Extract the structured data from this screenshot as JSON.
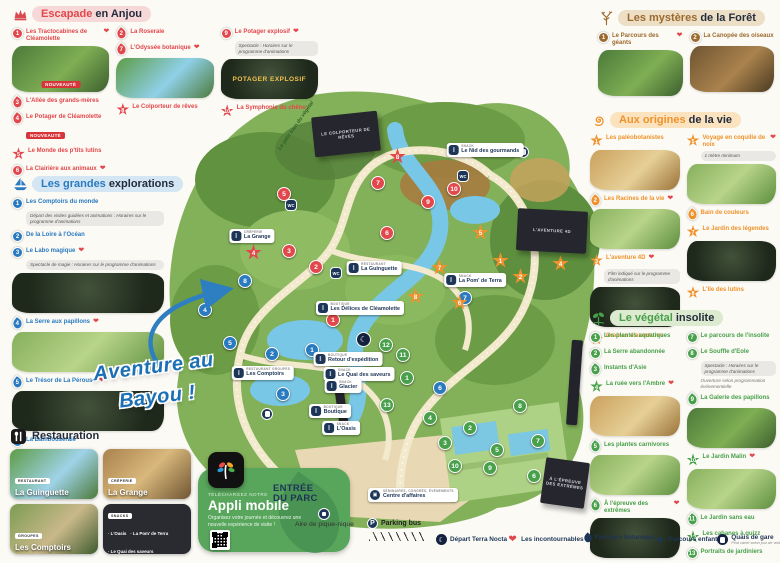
{
  "sections": {
    "escapade": {
      "title_accent": "Escapade",
      "title_rest": "en Anjou",
      "columns": [
        [
          {
            "n": 1,
            "sh": "c",
            "label": "Les Tractocabines de Cléamolette",
            "heart": true,
            "img": "th-g1",
            "img_badge": "NOUVEAUTÉ"
          },
          {
            "n": 3,
            "sh": "leaf",
            "label": "L'Allée des grands-mères"
          },
          {
            "n": 4,
            "sh": "leaf",
            "label": "Le Potager de Cléamolette",
            "badge": "NOUVEAUTÉ"
          },
          {
            "n": 5,
            "sh": "star",
            "label": "Le Monde des p'tits lutins"
          },
          {
            "n": 6,
            "sh": "c",
            "label": "La Clairière aux animaux",
            "heart": true
          }
        ],
        [
          {
            "n": 2,
            "sh": "leaf",
            "label": "La Roseraie"
          },
          {
            "n": 7,
            "sh": "leaf",
            "label": "L'Odyssée botanique",
            "heart": true,
            "img": "th-b1"
          },
          {
            "n": 8,
            "sh": "star",
            "label": "Le Colporteur de rêves"
          }
        ],
        [
          {
            "n": 9,
            "sh": "c",
            "label": "Le Potager explosif",
            "heart": true,
            "note": "Spectacle : Horaires sur le programme d'animations",
            "img": "th-d1",
            "img_text": "POTAGER EXPLOSIF"
          },
          {
            "n": 10,
            "sh": "star",
            "label": "La Symphonie du chêne"
          }
        ]
      ]
    },
    "explorations": {
      "title_accent": "Les grandes",
      "title_rest": "explorations",
      "columns": [
        [
          {
            "n": 1,
            "sh": "c",
            "label": "Les Comptoirs du monde",
            "note": "Départ des visites guidées et animations : Horaires sur le programme d'animations"
          },
          {
            "n": 2,
            "sh": "c",
            "label": "De la Loire à l'Océan"
          },
          {
            "n": 3,
            "sh": "c",
            "label": "Le Labo magique",
            "heart": true,
            "note": "Spectacle de magie : Horaires sur le programme d'animations",
            "img": "th-d1"
          },
          {
            "n": 4,
            "sh": "leaf",
            "label": "La Serre aux papillons",
            "heart": true,
            "img": "th-g2"
          },
          {
            "n": 5,
            "sh": "leaf",
            "label": "Le Trésor de La Pérouse",
            "heart": true,
            "img": "th-d1"
          },
          {
            "n": 6,
            "sh": "c",
            "label": "La Bambouseraie"
          },
          {
            "n": 7,
            "sh": "c",
            "label": "L'île aux sons"
          },
          {
            "n": 8,
            "sh": "c",
            "label": "Aventure au Bayou !"
          }
        ]
      ]
    },
    "foret": {
      "title_accent": "Les mystères",
      "title_rest": "de la Forêt",
      "columns": [
        [
          {
            "n": 1,
            "sh": "c",
            "label": "Le Parcours des géants",
            "heart": true,
            "img": "th-g1"
          }
        ],
        [
          {
            "n": 2,
            "sh": "c",
            "label": "La Canopée des oiseaux",
            "img": "th-k1"
          }
        ]
      ]
    },
    "origines": {
      "title_accent": "Aux origines",
      "title_rest": "de la vie",
      "columns": [
        [
          {
            "n": 1,
            "sh": "star",
            "label": "Les paléobotanistes",
            "img": "th-w1"
          },
          {
            "n": 2,
            "sh": "leaf",
            "label": "Les Racines de la vie",
            "heart": true,
            "img": "th-g2"
          },
          {
            "n": 3,
            "sh": "star",
            "label": "L'aventure 4D",
            "heart": true,
            "note": "Film indiqué sur le programme d'animations",
            "img": "th-d1"
          },
          {
            "n": 4,
            "sh": "star",
            "label": "Graines d'aventures"
          }
        ],
        [
          {
            "n": 5,
            "sh": "star",
            "label": "Voyage en coquille de noix",
            "heart": true,
            "note": "1 mètre minimum",
            "img": "th-g2"
          },
          {
            "n": 6,
            "sh": "leaf",
            "label": "Bain de couleurs"
          },
          {
            "n": 7,
            "sh": "star",
            "label": "Le Jardin des légendes",
            "img": "th-d1"
          },
          {
            "n": 8,
            "sh": "star",
            "label": "L'île des lutins"
          }
        ]
      ]
    },
    "vegetal": {
      "title_accent": "Le végétal",
      "title_rest": "insolite",
      "columns": [
        [
          {
            "n": 1,
            "sh": "c",
            "label": "Les plantes aquatiques"
          },
          {
            "n": 2,
            "sh": "c",
            "label": "La Serre abandonnée"
          },
          {
            "n": 3,
            "sh": "leaf",
            "label": "Instants d'Asie"
          },
          {
            "n": 4,
            "sh": "star",
            "label": "La ruée vers l'Ambre",
            "heart": true,
            "img": "th-w1"
          },
          {
            "n": 5,
            "sh": "leaf",
            "label": "Les plantes carnivores",
            "img": "th-g2"
          },
          {
            "n": 6,
            "sh": "leaf",
            "label": "À l'épreuve des extrêmes",
            "heart": true,
            "img": "th-d1"
          }
        ],
        [
          {
            "n": 7,
            "sh": "c",
            "label": "Le parcours de l'insolite"
          },
          {
            "n": 8,
            "sh": "c",
            "label": "Le Souffle d'Eole",
            "note": "Spectacle : Horaires sur le programme d'animations",
            "note2": "Ouverture selon programmation événementielle"
          },
          {
            "n": 9,
            "sh": "leaf",
            "label": "La Galerie des papillons",
            "img": "th-g1"
          },
          {
            "n": 10,
            "sh": "star",
            "label": "Le Jardin Malin",
            "heart": true,
            "img": "th-g2"
          },
          {
            "n": 11,
            "sh": "leaf",
            "label": "Le Jardin sans eau"
          },
          {
            "n": 12,
            "sh": "star",
            "label": "Les cabanes à quizz"
          },
          {
            "n": 13,
            "sh": "c",
            "label": "Portraits de jardiniers"
          }
        ]
      ]
    }
  },
  "restauration": {
    "title": "Restauration",
    "cards": [
      {
        "badge": "RESTAURANT",
        "name": "La Guinguette",
        "style": "rc-1"
      },
      {
        "badge": "CRÊPERIE",
        "name": "La Grange",
        "style": "rc-2"
      },
      {
        "badge": "GROUPES",
        "name": "Les Comptoirs",
        "style": "rc-3"
      },
      {
        "badge": "SNACKS",
        "list": [
          "L'Oasis",
          "La Pom' de Terra",
          "Le Quai des saveurs",
          "Le Nid des gourmands"
        ]
      }
    ]
  },
  "app": {
    "kicker": "TÉLÉCHARGEZ NOTRE",
    "title": "Appli mobile",
    "desc": "Organisez votre journée et découvrez une nouvelle expérience de visite !"
  },
  "bayou": {
    "line1": "Aventure au",
    "line2": "Bayou !"
  },
  "map": {
    "train_label": "Le petit train du végétal",
    "entrance_line1": "ENTRÉE",
    "entrance_line2": "DU PARC",
    "picnic_label": "Aire de pique-nique",
    "parking_label": "Parking bus",
    "business_badge": "SÉMINAIRES, CONGRÈS, ÉVÉNEMENTS",
    "business_name": "Centre d'affaires",
    "pills": [
      {
        "badge": "SNACK",
        "name": "Le Nid des gourmands",
        "x": 340,
        "y": 62
      },
      {
        "badge": "CRÊPERIE",
        "name": "La Grange",
        "x": 107,
        "y": 148
      },
      {
        "badge": "RESTAURANT",
        "name": "La Guinguette",
        "x": 229,
        "y": 180
      },
      {
        "badge": "BOUTIQUE",
        "name": "Les Délices de Cléamolette",
        "x": 215,
        "y": 220
      },
      {
        "badge": "BOUTIQUE",
        "name": "Retour d'expédition",
        "x": 203,
        "y": 271
      },
      {
        "badge": "RESTAURANT GROUPES",
        "name": "Les Comptoirs",
        "x": 118,
        "y": 285
      },
      {
        "badge": "SNACK",
        "name": "Le Quai des saveurs",
        "x": 214,
        "y": 286
      },
      {
        "badge": "SNACK",
        "name": "Glacier",
        "x": 198,
        "y": 298
      },
      {
        "badge": "SNACK",
        "name": "La Pom' de Terra",
        "x": 330,
        "y": 192
      },
      {
        "badge": "BOUTIQUE",
        "name": "Boutique",
        "x": 185,
        "y": 323
      },
      {
        "badge": "SNACK",
        "name": "L'Oasis",
        "x": 196,
        "y": 340
      }
    ],
    "buildings": [
      {
        "text": "LE COLPORTEUR DE RÊVES",
        "x": 168,
        "y": 26,
        "w": 66,
        "h": 40,
        "rot": -6
      },
      {
        "text": "L'AVENTURE 4D",
        "x": 372,
        "y": 122,
        "w": 70,
        "h": 42,
        "rot": 3
      },
      {
        "text": "À L'ÉPREUVE DES EXTRÊMES",
        "x": 398,
        "y": 372,
        "w": 44,
        "h": 46,
        "rot": 8
      }
    ],
    "markers": [
      {
        "t": "red",
        "sh": "c",
        "n": 1,
        "x": 188,
        "y": 232
      },
      {
        "t": "red",
        "sh": "c",
        "n": 2,
        "x": 171,
        "y": 179
      },
      {
        "t": "red",
        "sh": "c",
        "n": 3,
        "x": 144,
        "y": 163
      },
      {
        "t": "red",
        "sh": "s",
        "n": 4,
        "x": 108,
        "y": 164
      },
      {
        "t": "red",
        "sh": "c",
        "n": 5,
        "x": 139,
        "y": 106
      },
      {
        "t": "red",
        "sh": "c",
        "n": 6,
        "x": 242,
        "y": 145
      },
      {
        "t": "red",
        "sh": "c",
        "n": 7,
        "x": 233,
        "y": 95
      },
      {
        "t": "red",
        "sh": "s",
        "n": 8,
        "x": 252,
        "y": 68
      },
      {
        "t": "red",
        "sh": "c",
        "n": 9,
        "x": 283,
        "y": 114
      },
      {
        "t": "red",
        "sh": "c",
        "n": 10,
        "x": 309,
        "y": 101
      },
      {
        "t": "blue",
        "sh": "c",
        "n": 1,
        "x": 167,
        "y": 262
      },
      {
        "t": "blue",
        "sh": "c",
        "n": 2,
        "x": 127,
        "y": 266
      },
      {
        "t": "blue",
        "sh": "c",
        "n": 3,
        "x": 138,
        "y": 306
      },
      {
        "t": "blue",
        "sh": "c",
        "n": 4,
        "x": 60,
        "y": 222
      },
      {
        "t": "blue",
        "sh": "c",
        "n": 5,
        "x": 85,
        "y": 255
      },
      {
        "t": "blue",
        "sh": "c",
        "n": 6,
        "x": 295,
        "y": 300
      },
      {
        "t": "blue",
        "sh": "c",
        "n": 7,
        "x": 320,
        "y": 210
      },
      {
        "t": "blue",
        "sh": "c",
        "n": 8,
        "x": 100,
        "y": 193
      },
      {
        "t": "orange",
        "sh": "s",
        "n": 1,
        "x": 355,
        "y": 172
      },
      {
        "t": "orange",
        "sh": "s",
        "n": 2,
        "x": 375,
        "y": 188
      },
      {
        "t": "orange",
        "sh": "s",
        "n": 3,
        "x": 386,
        "y": 130
      },
      {
        "t": "orange",
        "sh": "s",
        "n": 4,
        "x": 415,
        "y": 175
      },
      {
        "t": "orange",
        "sh": "s",
        "n": 5,
        "x": 335,
        "y": 144
      },
      {
        "t": "orange",
        "sh": "s",
        "n": 6,
        "x": 314,
        "y": 214
      },
      {
        "t": "orange",
        "sh": "s",
        "n": 7,
        "x": 294,
        "y": 179
      },
      {
        "t": "orange",
        "sh": "s",
        "n": 8,
        "x": 270,
        "y": 208
      },
      {
        "t": "green",
        "sh": "c",
        "n": 1,
        "x": 262,
        "y": 290
      },
      {
        "t": "green",
        "sh": "c",
        "n": 2,
        "x": 325,
        "y": 340
      },
      {
        "t": "green",
        "sh": "c",
        "n": 3,
        "x": 300,
        "y": 355
      },
      {
        "t": "green",
        "sh": "c",
        "n": 4,
        "x": 285,
        "y": 330
      },
      {
        "t": "green",
        "sh": "c",
        "n": 5,
        "x": 352,
        "y": 362
      },
      {
        "t": "green",
        "sh": "c",
        "n": 6,
        "x": 389,
        "y": 388
      },
      {
        "t": "green",
        "sh": "c",
        "n": 7,
        "x": 393,
        "y": 353
      },
      {
        "t": "green",
        "sh": "c",
        "n": 8,
        "x": 375,
        "y": 318
      },
      {
        "t": "green",
        "sh": "c",
        "n": 9,
        "x": 345,
        "y": 380
      },
      {
        "t": "green",
        "sh": "c",
        "n": 10,
        "x": 310,
        "y": 378
      },
      {
        "t": "green",
        "sh": "c",
        "n": 11,
        "x": 258,
        "y": 267
      },
      {
        "t": "green",
        "sh": "c",
        "n": 12,
        "x": 241,
        "y": 257
      },
      {
        "t": "green",
        "sh": "c",
        "n": 13,
        "x": 242,
        "y": 317
      }
    ],
    "facilities": [
      {
        "t": "wc",
        "x": 207,
        "y": 56
      },
      {
        "t": "wc",
        "x": 318,
        "y": 88
      },
      {
        "t": "wc",
        "x": 146,
        "y": 117
      },
      {
        "t": "wc",
        "x": 191,
        "y": 185
      },
      {
        "t": "moon",
        "x": 217,
        "y": 250
      },
      {
        "t": "train",
        "x": 122,
        "y": 326
      },
      {
        "t": "train",
        "x": 378,
        "y": 64
      }
    ]
  },
  "footer_legend": [
    {
      "icon": "moon",
      "label": "Départ Terra Nocta"
    },
    {
      "icon": "heart",
      "label": "Les incontournables"
    },
    {
      "icon": "leaf",
      "label": "Parcours botanique"
    },
    {
      "icon": "star",
      "label": "Parcours enfant"
    },
    {
      "icon": "train",
      "label": "Quais de gare",
      "sub": "Peut varier selon jour de visite"
    }
  ],
  "colors": {
    "red": "#e2474b",
    "blue": "#2a7abf",
    "brown": "#9c6a2d",
    "orange": "#f0922b",
    "green": "#48a04b",
    "navy": "#1d3557",
    "map_green": "#83b15a",
    "water": "#79c7e6",
    "path": "#f3e9cd"
  }
}
